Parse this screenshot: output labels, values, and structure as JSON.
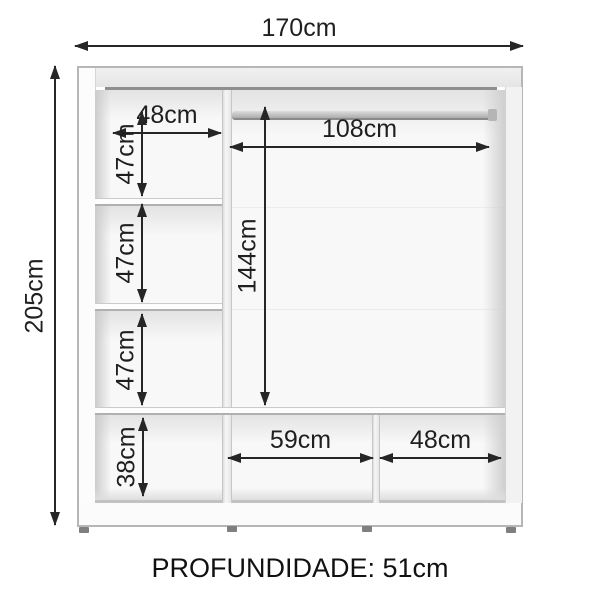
{
  "footer": {
    "text": "PROFUNDIDADE: 51cm"
  },
  "dimensions": {
    "overall_width": "170cm",
    "overall_height": "205cm",
    "left_column_width": "48cm",
    "left_comp1_height": "47cm",
    "left_comp2_height": "47cm",
    "left_comp3_height": "47cm",
    "left_comp4_height": "38cm",
    "rod_section_width": "108cm",
    "hanging_height": "144cm",
    "bottom_middle_width": "59cm",
    "bottom_right_width": "48cm"
  },
  "colors": {
    "dimension_line": "#262626",
    "cabinet_outline": "#b6b6b6",
    "top_shadow": "#8e8e8e",
    "background": "#ffffff"
  }
}
